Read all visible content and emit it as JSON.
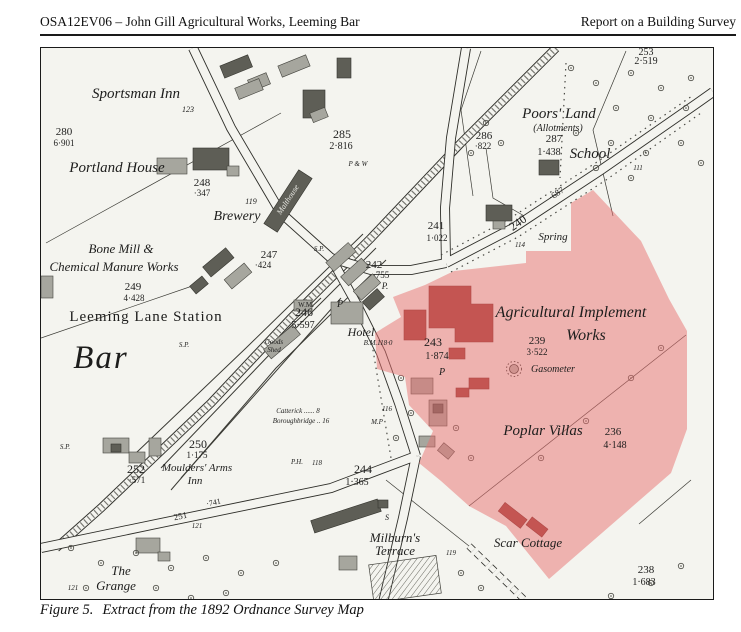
{
  "header": {
    "left": "OSA12EV06 – John Gill Agricultural Works, Leeming Bar",
    "right": "Report on a Building Survey"
  },
  "caption": {
    "figure": "Figure 5.",
    "text": "Extract from the 1892 Ordnance Survey Map"
  },
  "map": {
    "highlight_color": "#e87070",
    "labels": {
      "sportsman_inn": "Sportsman Inn",
      "n123": "123",
      "n280": "280",
      "n280a": "6·901",
      "portland_house": "Portland House",
      "n248": "248",
      "n248a": "·347",
      "n119_brewery": "119",
      "brewery": "Brewery",
      "malthouse": "Malthouse",
      "bone_mill_1": "Bone Mill &",
      "bone_mill_2": "Chemical Manure Works",
      "n249": "249",
      "n249a": "4·428",
      "leeming_lane_station": "Leeming Lane Station",
      "bar": "Bar",
      "sp": "S.P.",
      "n247": "247",
      "n247a": "·424",
      "n285": "285",
      "n285a": "2·816",
      "pw": "P & W",
      "n242": "242",
      "n242a": "·755",
      "p_dot": "P.",
      "p1": "P",
      "p2": "P",
      "wm": "W.M.",
      "n246": "246",
      "n246a": "5·597",
      "hotel": "Hotel",
      "bm118": "B.M.118·0",
      "goods_1": "Goods",
      "goods_2": "Shed",
      "n241": "241",
      "n241a": "1·022",
      "n240": "240",
      "n240a": "·687",
      "n114": "114",
      "n111": "111",
      "spring": "Spring",
      "poors_land": "Poors' Land",
      "allotments": "(Allotments)",
      "n287": "287",
      "n287a": "1·438",
      "school": "School",
      "n286": "286",
      "n286a": "·822",
      "n253": "253",
      "n253a": "2·519",
      "n243": "243",
      "n243a": "1·874",
      "agimpl_1": "Agricultural Implement",
      "agimpl_2": "Works",
      "n239": "239",
      "n239a": "3·522",
      "gasometer": "Gasometer",
      "poplar_villas": "Poplar Villas",
      "n236": "236",
      "n236a": "4·148",
      "n116": "116",
      "mp": "M.P",
      "catterick": "Catterick ...... 8",
      "boroughbridge": "Boroughbridge .. 16",
      "n250": "250",
      "n250a": "1·175",
      "n252": "252",
      "n252a": "·571",
      "moulders_1": "Moulders' Arms",
      "moulders_2": "Inn",
      "ph": "P.H.",
      "n118": "118",
      "n244": "244",
      "n244a": "1·365",
      "n251": "251",
      "n251a": "·741",
      "n121a": "121",
      "n121b": "121",
      "grange_1": "The",
      "grange_2": "Grange",
      "milburns_1": "Milburn's",
      "milburns_2": "Terrace",
      "s_label": "S",
      "n119_terrace": "119",
      "scar_cottage": "Scar Cottage",
      "n238": "238",
      "n238a": "1·683"
    }
  }
}
